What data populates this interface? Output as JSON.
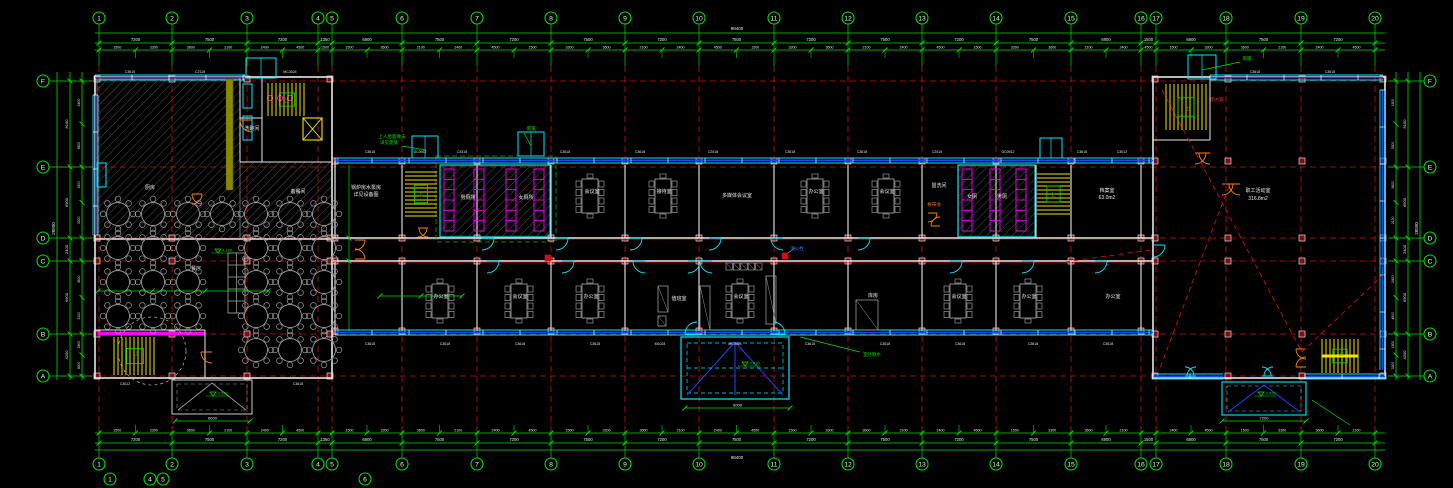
{
  "meta": {
    "title": "首层平面图 — CAD floor plan",
    "app": "cad-viewport"
  },
  "colors": {
    "bg": "#000000",
    "grid_green": "#00dd00",
    "axis_red": "#cc1010",
    "wall": "#e8e8e8",
    "window_cyan": "#00eaff",
    "window_blue": "#2244ff",
    "stair_yellow": "#f5e400",
    "fixture_magenta": "#ff00ff",
    "door_orange": "#ff8400",
    "furniture_gray": "#9a9a9a",
    "hatch_gray": "#8a8a8a",
    "text_white": "#e8e8e8",
    "annot_green": "#00e000",
    "olive_strip": "#8a8a00",
    "column_fill": "#801010"
  },
  "axes": {
    "top": {
      "bubble_y": 18,
      "labels": [
        "1",
        "2",
        "3",
        "4",
        "5",
        "6",
        "7",
        "8",
        "9",
        "10",
        "11",
        "12",
        "13",
        "14",
        "15",
        "16",
        "17",
        "18",
        "19",
        "20"
      ],
      "x": [
        99,
        172,
        247,
        318,
        332,
        402,
        477,
        551,
        625,
        699,
        774,
        848,
        922,
        996,
        1071,
        1141,
        1156,
        1226,
        1301,
        1375
      ]
    },
    "bottom": {
      "bubble_y": 464,
      "extra": [
        {
          "label": "1",
          "x": 110,
          "y": 479
        },
        {
          "label": "4",
          "x": 150,
          "y": 479
        },
        {
          "label": "5",
          "x": 163,
          "y": 479
        },
        {
          "label": "6",
          "x": 365,
          "y": 479
        }
      ]
    },
    "rows": {
      "labels": [
        "F",
        "E",
        "D",
        "C",
        "B",
        "A"
      ],
      "y": [
        81,
        167,
        238,
        261,
        334,
        376
      ],
      "left_x": 43,
      "right_x": 1430
    }
  },
  "dims": {
    "top_major": [
      "7200",
      "7500",
      "7200",
      "1350",
      "6900",
      "7500",
      "7200",
      "7500",
      "7200",
      "7500",
      "7200",
      "7500",
      "7200",
      "7500",
      "6900",
      "1500",
      "6900",
      "7500",
      "7200"
    ],
    "fine_cycle": [
      "1500",
      "3300",
      "3600",
      "2100",
      "2400",
      "4500"
    ],
    "row_major": [
      "8100",
      "6900",
      "2400",
      "6900",
      "4200"
    ],
    "total_w": "98400",
    "total_h": "28500"
  },
  "rooms": [
    {
      "t": "厨房",
      "x": 150,
      "y": 189
    },
    {
      "t": "备餐间",
      "x": 298,
      "y": 193
    },
    {
      "t": "洗碗间",
      "x": 252,
      "y": 130
    },
    {
      "t": "餐厅",
      "x": 196,
      "y": 270
    },
    {
      "t": "锅炉房水泵房",
      "x": 366,
      "y": 189
    },
    {
      "t": "详见设备图",
      "x": 366,
      "y": 196
    },
    {
      "t": "男厕所",
      "x": 468,
      "y": 199
    },
    {
      "t": "女厕所",
      "x": 526,
      "y": 199
    },
    {
      "t": "会议室",
      "x": 592,
      "y": 193
    },
    {
      "t": "接待室",
      "x": 664,
      "y": 193
    },
    {
      "t": "多媒体会议室",
      "x": 737,
      "y": 197
    },
    {
      "t": "办公室",
      "x": 816,
      "y": 193
    },
    {
      "t": "会议室",
      "x": 887,
      "y": 193
    },
    {
      "t": "盥洗间",
      "x": 939,
      "y": 187
    },
    {
      "t": "女厕",
      "x": 972,
      "y": 198
    },
    {
      "t": "男厕",
      "x": 1002,
      "y": 198
    },
    {
      "t": "档案室",
      "x": 1107,
      "y": 192
    },
    {
      "t": "63.0m2",
      "x": 1107,
      "y": 199
    },
    {
      "t": "职工活动室",
      "x": 1258,
      "y": 192
    },
    {
      "t": "316.8m2",
      "x": 1258,
      "y": 200
    },
    {
      "t": "办公室",
      "x": 441,
      "y": 298
    },
    {
      "t": "会议室",
      "x": 520,
      "y": 298
    },
    {
      "t": "办公室",
      "x": 591,
      "y": 298
    },
    {
      "t": "值班室",
      "x": 679,
      "y": 300
    },
    {
      "t": "会议室",
      "x": 741,
      "y": 298
    },
    {
      "t": "库房",
      "x": 873,
      "y": 297
    },
    {
      "t": "会议室",
      "x": 959,
      "y": 298
    },
    {
      "t": "办公室",
      "x": 1029,
      "y": 298
    },
    {
      "t": "办公室",
      "x": 1113,
      "y": 298
    }
  ],
  "annotations": [
    {
      "t": "上人屋面做法",
      "x": 392,
      "y": 138,
      "c": "#00e000"
    },
    {
      "t": "详见建施",
      "x": 389,
      "y": 144,
      "c": "#00e000"
    },
    {
      "t": "雨篷",
      "x": 531,
      "y": 130,
      "c": "#00e000"
    },
    {
      "t": "雨篷",
      "x": 1247,
      "y": 60,
      "c": "#00e000"
    },
    {
      "t": "雨水管",
      "x": 1217,
      "y": 101,
      "c": "#ff3030"
    },
    {
      "t": "室外散水",
      "x": 872,
      "y": 356,
      "c": "#00e000"
    },
    {
      "t": "消火栓",
      "x": 797,
      "y": 250,
      "c": "#4080ff"
    },
    {
      "t": "拖布池",
      "x": 934,
      "y": 206,
      "c": "#ff8000"
    },
    {
      "t": "上",
      "x": 286,
      "y": 102,
      "c": "#00e000"
    },
    {
      "t": "上",
      "x": 137,
      "y": 355,
      "c": "#00e000"
    },
    {
      "t": "上",
      "x": 421,
      "y": 196,
      "c": "#00e000"
    },
    {
      "t": "上",
      "x": 1053,
      "y": 196,
      "c": "#00e000"
    },
    {
      "t": "上",
      "x": 1188,
      "y": 110,
      "c": "#00e000"
    },
    {
      "t": "上",
      "x": 1341,
      "y": 355,
      "c": "#00e000"
    }
  ],
  "levels": [
    {
      "x": 215,
      "y": 253,
      "t": "4.180"
    },
    {
      "x": 742,
      "y": 366,
      "t": "-0.020"
    },
    {
      "x": 1258,
      "y": 396,
      "t": "-0.020"
    },
    {
      "x": 210,
      "y": 396,
      "t": "-0.020"
    }
  ],
  "window_tags": [
    {
      "t": "C3615",
      "x": 130,
      "y": 73
    },
    {
      "t": "C2115",
      "x": 200,
      "y": 73
    },
    {
      "t": "MC3024",
      "x": 290,
      "y": 73
    },
    {
      "t": "C3618",
      "x": 1255,
      "y": 73
    },
    {
      "t": "C3618",
      "x": 1330,
      "y": 73
    },
    {
      "t": "C3618",
      "x": 370,
      "y": 153
    },
    {
      "t": "GC0912",
      "x": 420,
      "y": 153
    },
    {
      "t": "C3315",
      "x": 462,
      "y": 153
    },
    {
      "t": "C3618",
      "x": 565,
      "y": 153
    },
    {
      "t": "C3618",
      "x": 640,
      "y": 153
    },
    {
      "t": "C2418",
      "x": 713,
      "y": 153
    },
    {
      "t": "C3618",
      "x": 790,
      "y": 153
    },
    {
      "t": "C3618",
      "x": 862,
      "y": 153
    },
    {
      "t": "C2415",
      "x": 937,
      "y": 153
    },
    {
      "t": "GC0912",
      "x": 1008,
      "y": 153
    },
    {
      "t": "C3618",
      "x": 1082,
      "y": 153
    },
    {
      "t": "C3012",
      "x": 1122,
      "y": 153
    },
    {
      "t": "C3618",
      "x": 370,
      "y": 345
    },
    {
      "t": "C3618",
      "x": 445,
      "y": 345
    },
    {
      "t": "C3618",
      "x": 520,
      "y": 345
    },
    {
      "t": "C3618",
      "x": 595,
      "y": 345
    },
    {
      "t": "M1024",
      "x": 660,
      "y": 345
    },
    {
      "t": "MC3024",
      "x": 735,
      "y": 345
    },
    {
      "t": "C3618",
      "x": 810,
      "y": 345
    },
    {
      "t": "C3618",
      "x": 885,
      "y": 345
    },
    {
      "t": "C3618",
      "x": 960,
      "y": 345
    },
    {
      "t": "C3618",
      "x": 1033,
      "y": 345
    },
    {
      "t": "C3618",
      "x": 1108,
      "y": 345
    },
    {
      "t": "C3012",
      "x": 125,
      "y": 385
    },
    {
      "t": "C3618",
      "x": 298,
      "y": 385
    }
  ],
  "canopy_dims": [
    {
      "x1": 685,
      "x2": 790,
      "y": 408,
      "t": "9000"
    },
    {
      "x1": 1222,
      "x2": 1306,
      "y": 421,
      "t": "7200"
    },
    {
      "x1": 175,
      "x2": 250,
      "y": 421,
      "t": "6600"
    }
  ],
  "round_table_clusters": [
    {
      "cols": [
        118,
        153,
        188
      ],
      "rows": [
        214,
        248,
        282,
        316
      ]
    },
    {
      "cols": [
        256,
        290,
        324
      ],
      "rows": [
        214,
        248,
        282,
        316,
        350
      ]
    },
    {
      "cols": [
        222
      ],
      "rows": [
        214
      ]
    }
  ],
  "conf_tables": [
    {
      "x": 590,
      "y": 196
    },
    {
      "x": 663,
      "y": 196
    },
    {
      "x": 815,
      "y": 196
    },
    {
      "x": 886,
      "y": 196
    },
    {
      "x": 440,
      "y": 301
    },
    {
      "x": 519,
      "y": 301
    },
    {
      "x": 590,
      "y": 301
    },
    {
      "x": 740,
      "y": 301
    },
    {
      "x": 958,
      "y": 301
    },
    {
      "x": 1028,
      "y": 301
    }
  ],
  "doors": [
    {
      "x": 482,
      "y": 238,
      "r": 12,
      "dx": 1,
      "dy": 1,
      "c": "cy"
    },
    {
      "x": 556,
      "y": 238,
      "r": 12,
      "dx": 1,
      "dy": 1,
      "c": "cy"
    },
    {
      "x": 630,
      "y": 238,
      "r": 12,
      "dx": 1,
      "dy": 1,
      "c": "cy"
    },
    {
      "x": 709,
      "y": 238,
      "r": 12,
      "dx": 1,
      "dy": 1,
      "c": "cy"
    },
    {
      "x": 783,
      "y": 238,
      "r": 12,
      "dx": -1,
      "dy": 1,
      "c": "cy"
    },
    {
      "x": 858,
      "y": 238,
      "r": 12,
      "dx": 1,
      "dy": 1,
      "c": "cy"
    },
    {
      "x": 487,
      "y": 261,
      "r": 12,
      "dx": 1,
      "dy": 1,
      "c": "cy"
    },
    {
      "x": 562,
      "y": 261,
      "r": 12,
      "dx": 1,
      "dy": 1,
      "c": "cy"
    },
    {
      "x": 645,
      "y": 261,
      "r": 12,
      "dx": -1,
      "dy": 1,
      "c": "cy"
    },
    {
      "x": 688,
      "y": 261,
      "r": 12,
      "dx": 1,
      "dy": 1,
      "c": "cy"
    },
    {
      "x": 712,
      "y": 261,
      "r": 12,
      "dx": -1,
      "dy": 1,
      "c": "cy"
    },
    {
      "x": 950,
      "y": 261,
      "r": 12,
      "dx": 1,
      "dy": 1,
      "c": "cy"
    },
    {
      "x": 1022,
      "y": 261,
      "r": 12,
      "dx": 1,
      "dy": 1,
      "c": "cy"
    },
    {
      "x": 1095,
      "y": 261,
      "r": 12,
      "dx": 1,
      "dy": 1,
      "c": "cy"
    },
    {
      "x": 1153,
      "y": 245,
      "r": 12,
      "dx": 1,
      "dy": 1,
      "c": "cy"
    },
    {
      "x": 697,
      "y": 334,
      "r": 12,
      "dx": -1,
      "dy": -1,
      "c": "cy"
    },
    {
      "x": 773,
      "y": 334,
      "r": 12,
      "dx": 1,
      "dy": -1,
      "c": "cy"
    },
    {
      "x": 1185,
      "y": 376,
      "r": 9,
      "dx": 1,
      "dy": -1,
      "c": "cy"
    },
    {
      "x": 1196,
      "y": 376,
      "r": 9,
      "dx": -1,
      "dy": -1,
      "c": "cy"
    },
    {
      "x": 1262,
      "y": 376,
      "r": 9,
      "dx": 1,
      "dy": -1,
      "c": "cy"
    },
    {
      "x": 1273,
      "y": 376,
      "r": 9,
      "dx": -1,
      "dy": -1,
      "c": "cy"
    },
    {
      "x": 355,
      "y": 240,
      "r": 10,
      "dx": 1,
      "dy": 1,
      "c": "or"
    },
    {
      "x": 355,
      "y": 259,
      "r": 10,
      "dx": 1,
      "dy": -1,
      "c": "or"
    },
    {
      "x": 1222,
      "y": 184,
      "r": 11,
      "dx": 1,
      "dy": 1,
      "c": "or"
    },
    {
      "x": 1240,
      "y": 184,
      "r": 11,
      "dx": -1,
      "dy": 1,
      "c": "or"
    },
    {
      "x": 252,
      "y": 120,
      "r": 12,
      "dx": -1,
      "dy": 1,
      "c": "or"
    },
    {
      "x": 192,
      "y": 194,
      "r": 10,
      "dx": 1,
      "dy": 1,
      "c": "or"
    },
    {
      "x": 202,
      "y": 194,
      "r": 10,
      "dx": -1,
      "dy": 1,
      "c": "or"
    },
    {
      "x": 212,
      "y": 352,
      "r": 11,
      "dx": -1,
      "dy": 1,
      "c": "or"
    },
    {
      "x": 1306,
      "y": 349,
      "r": 10,
      "dx": -1,
      "dy": 1,
      "c": "or"
    },
    {
      "x": 1306,
      "y": 367,
      "r": 10,
      "dx": -1,
      "dy": -1,
      "c": "or"
    },
    {
      "x": 928,
      "y": 213,
      "r": 9,
      "dx": 1,
      "dy": 1,
      "c": "or"
    },
    {
      "x": 940,
      "y": 226,
      "r": 9,
      "dx": -1,
      "dy": -1,
      "c": "or"
    },
    {
      "x": 418,
      "y": 228,
      "r": 9,
      "dx": 1,
      "dy": 1,
      "c": "or"
    },
    {
      "x": 428,
      "y": 228,
      "r": 9,
      "dx": -1,
      "dy": 1,
      "c": "or"
    },
    {
      "x": 1195,
      "y": 153,
      "r": 11,
      "dx": 1,
      "dy": 1,
      "c": "or"
    },
    {
      "x": 1210,
      "y": 153,
      "r": 11,
      "dx": -1,
      "dy": 1,
      "c": "or"
    }
  ],
  "stairs": [
    {
      "x": 268,
      "y": 83,
      "w": 38,
      "h": 33,
      "d": "v"
    },
    {
      "x": 114,
      "y": 337,
      "w": 42,
      "h": 38,
      "d": "v"
    },
    {
      "x": 405,
      "y": 172,
      "w": 32,
      "h": 44,
      "d": "h"
    },
    {
      "x": 1037,
      "y": 174,
      "w": 33,
      "h": 40,
      "d": "h"
    },
    {
      "x": 1166,
      "y": 84,
      "w": 40,
      "h": 46,
      "d": "v"
    },
    {
      "x": 1322,
      "y": 339,
      "w": 36,
      "h": 34,
      "d": "v"
    }
  ],
  "hatch_areas": [
    {
      "x": 97,
      "y": 79,
      "w": 143,
      "h": 160
    },
    {
      "x": 240,
      "y": 162,
      "w": 92,
      "h": 77
    },
    {
      "x": 440,
      "y": 166,
      "w": 110,
      "h": 70
    },
    {
      "x": 958,
      "y": 166,
      "w": 77,
      "h": 70
    }
  ],
  "stall_combs": [
    {
      "x": 444,
      "y": 169,
      "h": 62
    },
    {
      "x": 474,
      "y": 169,
      "h": 62
    },
    {
      "x": 506,
      "y": 169,
      "h": 62
    },
    {
      "x": 534,
      "y": 169,
      "h": 62
    },
    {
      "x": 962,
      "y": 169,
      "h": 62
    },
    {
      "x": 990,
      "y": 169,
      "h": 62
    },
    {
      "x": 1016,
      "y": 169,
      "h": 62
    }
  ]
}
